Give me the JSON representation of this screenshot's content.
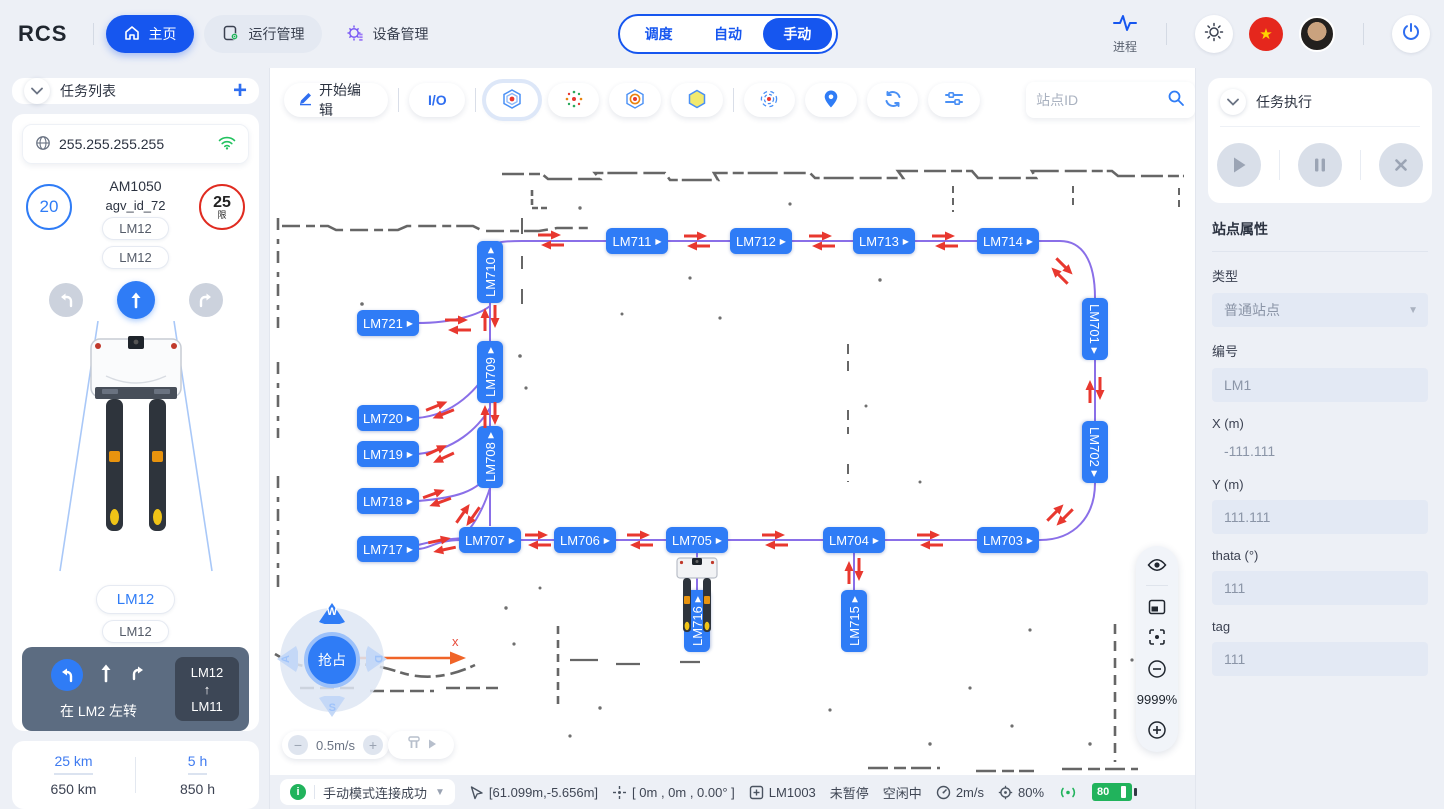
{
  "header": {
    "logo": "RCS",
    "nav_home": "主页",
    "nav_ops": "运行管理",
    "nav_device": "设备管理",
    "modes": {
      "m1": "调度",
      "m2": "自动",
      "m3": "手动",
      "active": "手动"
    },
    "process_label": "进程"
  },
  "left": {
    "task_list_title": "任务列表",
    "ip": "255.255.255.255",
    "vehicle": {
      "speed": "20",
      "model": "AM1050",
      "id": "agv_id_72",
      "limit": "25",
      "limit_tag": "限",
      "station_a": "LM12",
      "station_b": "LM12",
      "station_c": "LM12",
      "station_d": "LM12"
    },
    "nav_hint": {
      "text": "在 LM2 左转",
      "from": "LM12",
      "to": "LM11"
    },
    "stats": {
      "today_km": "25 km",
      "total_km": "650 km",
      "today_h": "5 h",
      "total_h": "850 h"
    }
  },
  "toolbar": {
    "edit": "开始编辑",
    "io": "I/O",
    "search_placeholder": "站点ID"
  },
  "map": {
    "zoom": "9999%",
    "axis_label": "x",
    "speed": "0.5m/s",
    "joystick": {
      "up": "W",
      "left": "A",
      "right": "D",
      "down": "S",
      "center": "抢占"
    },
    "stations": [
      {
        "id": "LM710",
        "x": 220,
        "y": 204,
        "o": "vu"
      },
      {
        "id": "LM709",
        "x": 220,
        "y": 304,
        "o": "vu"
      },
      {
        "id": "LM708",
        "x": 220,
        "y": 389,
        "o": "vu"
      },
      {
        "id": "LM711",
        "x": 367,
        "y": 173,
        "o": "h"
      },
      {
        "id": "LM712",
        "x": 491,
        "y": 173,
        "o": "h"
      },
      {
        "id": "LM713",
        "x": 614,
        "y": 173,
        "o": "h"
      },
      {
        "id": "LM714",
        "x": 738,
        "y": 173,
        "o": "h"
      },
      {
        "id": "LM701",
        "x": 825,
        "y": 261,
        "o": "vd"
      },
      {
        "id": "LM702",
        "x": 825,
        "y": 384,
        "o": "vd"
      },
      {
        "id": "LM703",
        "x": 738,
        "y": 472,
        "o": "h"
      },
      {
        "id": "LM704",
        "x": 584,
        "y": 472,
        "o": "h"
      },
      {
        "id": "LM705",
        "x": 427,
        "y": 472,
        "o": "h"
      },
      {
        "id": "LM706",
        "x": 315,
        "y": 472,
        "o": "h"
      },
      {
        "id": "LM707",
        "x": 220,
        "y": 472,
        "o": "h"
      },
      {
        "id": "LM716",
        "x": 427,
        "y": 553,
        "o": "vu"
      },
      {
        "id": "LM715",
        "x": 584,
        "y": 553,
        "o": "vu"
      },
      {
        "id": "LM717",
        "x": 118,
        "y": 481,
        "o": "h"
      },
      {
        "id": "LM718",
        "x": 118,
        "y": 433,
        "o": "h"
      },
      {
        "id": "LM719",
        "x": 118,
        "y": 386,
        "o": "h"
      },
      {
        "id": "LM720",
        "x": 118,
        "y": 350,
        "o": "h"
      },
      {
        "id": "LM721",
        "x": 118,
        "y": 255,
        "o": "h"
      }
    ],
    "arrows": [
      {
        "x": 188,
        "y": 257,
        "r": 0
      },
      {
        "x": 220,
        "y": 250,
        "r": 90
      },
      {
        "x": 281,
        "y": 172,
        "r": 0
      },
      {
        "x": 427,
        "y": 173,
        "r": 0
      },
      {
        "x": 552,
        "y": 173,
        "r": 0
      },
      {
        "x": 675,
        "y": 173,
        "r": 0
      },
      {
        "x": 792,
        "y": 203,
        "r": 45
      },
      {
        "x": 825,
        "y": 322,
        "r": 90
      },
      {
        "x": 790,
        "y": 447,
        "r": -45
      },
      {
        "x": 660,
        "y": 472,
        "r": 0
      },
      {
        "x": 505,
        "y": 472,
        "r": 0
      },
      {
        "x": 370,
        "y": 472,
        "r": 0
      },
      {
        "x": 268,
        "y": 472,
        "r": 0
      },
      {
        "x": 584,
        "y": 503,
        "r": 90
      },
      {
        "x": 220,
        "y": 347,
        "r": 90
      },
      {
        "x": 170,
        "y": 342,
        "r": -22
      },
      {
        "x": 170,
        "y": 386,
        "r": -25
      },
      {
        "x": 167,
        "y": 430,
        "r": -20
      },
      {
        "x": 198,
        "y": 447,
        "r": -55
      },
      {
        "x": 172,
        "y": 477,
        "r": -12
      }
    ]
  },
  "right": {
    "exec_title": "任务执行",
    "props_title": "站点属性",
    "fields": {
      "type_label": "类型",
      "type_value": "普通站点",
      "code_label": "编号",
      "code_value": "LM1",
      "x_label": "X (m)",
      "x_value": "-111.111",
      "y_label": "Y (m)",
      "y_value": "111.111",
      "theta_label": "thata (°)",
      "theta_value": "111",
      "tag_label": "tag",
      "tag_value": "111"
    }
  },
  "status": {
    "message": "手动模式连接成功",
    "coords": "[61.099m,-5.656m]",
    "pose": "[ 0m , 0m , 0.00° ]",
    "station": "LM1003",
    "pause": "未暂停",
    "state": "空闲中",
    "speed": "2m/s",
    "position": "80%",
    "battery": "80"
  }
}
